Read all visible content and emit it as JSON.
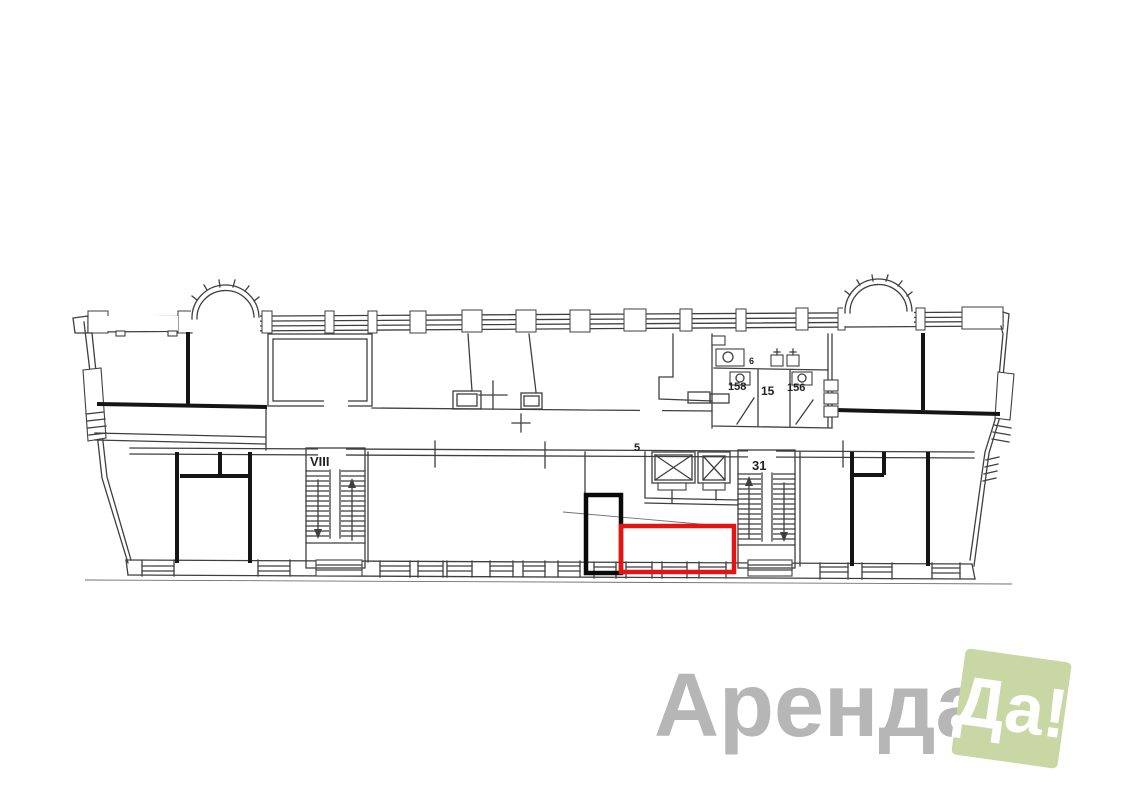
{
  "colors": {
    "background": "#ffffff",
    "drawing_line": "#3f3f3f",
    "thick_wall": "#151515",
    "highlight_red": "#e51414",
    "secondary_outline_black": "#0a0a0a",
    "stair_label_red": "#8e2038",
    "label_dark": "#222222",
    "logo_gray": "#b6b6b6",
    "logo_green": "#c9d7a5",
    "logo_badge_text": "#ffffff"
  },
  "plan": {
    "labels": {
      "left_staircase": "VIII",
      "right_staircase": "31",
      "elevator_lobby": "5",
      "wc_left_stall": "158",
      "wc_room": "15",
      "wc_right_stall": "156",
      "wc_fixture": "6"
    }
  },
  "logo": {
    "wordmark": "Аренда",
    "badge": "Да!"
  }
}
